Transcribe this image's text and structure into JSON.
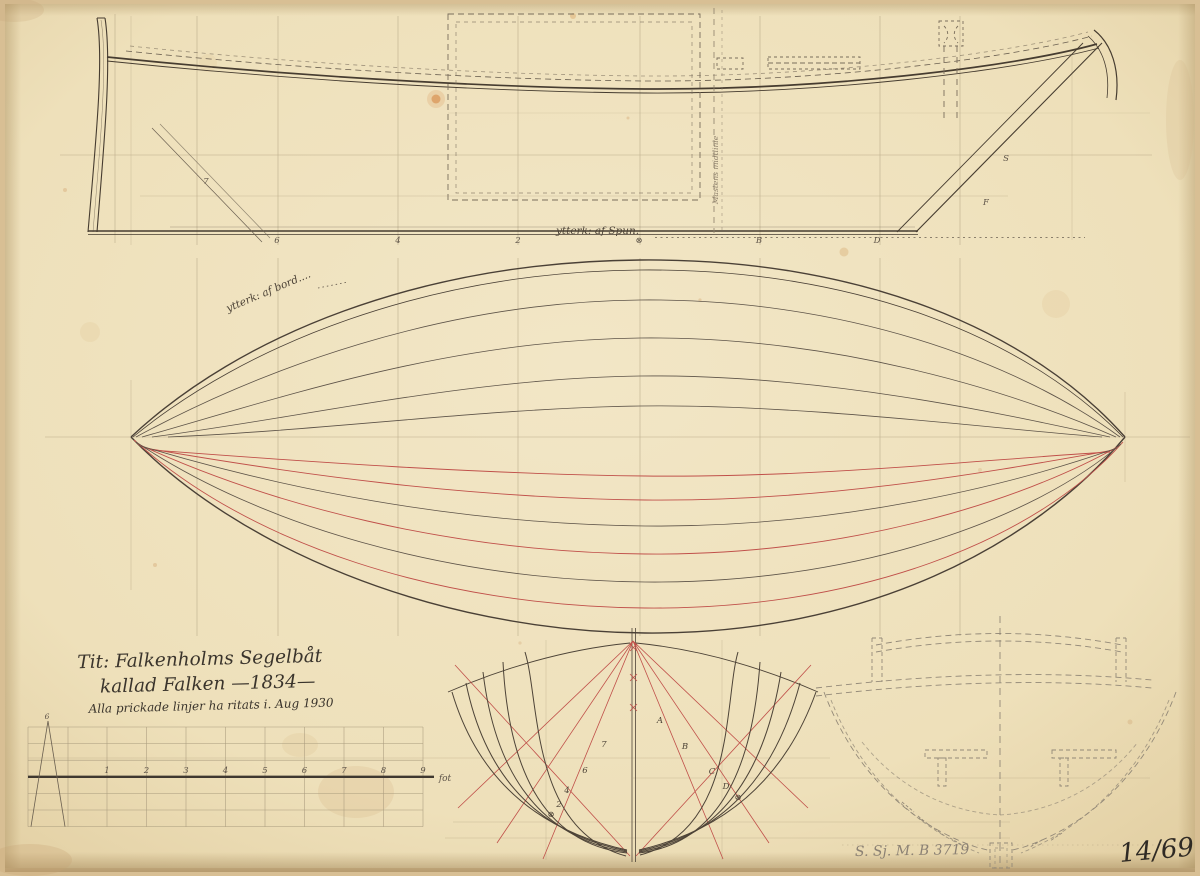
{
  "title_block": {
    "line1": "Tit: Falkenholms Segelbåt",
    "line2": "kallad Falken —1834—",
    "line3": "Alla prickade linjer ha ritats i.  Aug 1930"
  },
  "annotations": {
    "rabbet_line": "ytterk: af Spun.",
    "plank_line": "ytterk: af bord....",
    "mast_centerline": "Mastens midtlinie"
  },
  "profile": {
    "keel_stations": [
      "6",
      "4",
      "2",
      "⊗",
      "B",
      "D"
    ],
    "bow_station": "7",
    "stern_station_upper": "S",
    "stern_station_lower": "F"
  },
  "body_plan": {
    "left_stations": [
      "7",
      "6",
      "4",
      "2",
      "⊗"
    ],
    "right_stations": [
      "A",
      "B",
      "C",
      "D",
      "⊗"
    ]
  },
  "scale_bar": {
    "numbers": [
      "1",
      "2",
      "3",
      "4",
      "5",
      "6",
      "7",
      "8",
      "9"
    ],
    "unit": "fot",
    "fine_division": "6"
  },
  "stamps": {
    "archive_number": "S. Sj. M. B 3719",
    "sheet_number": "14/69"
  },
  "colors": {
    "paper": "#efe2bf",
    "pencil_light": "#b3a383",
    "pencil_dark": "#6a5f50",
    "ink": "#463c30",
    "red_line": "#c0504a",
    "handwriting": "#3a342c"
  }
}
